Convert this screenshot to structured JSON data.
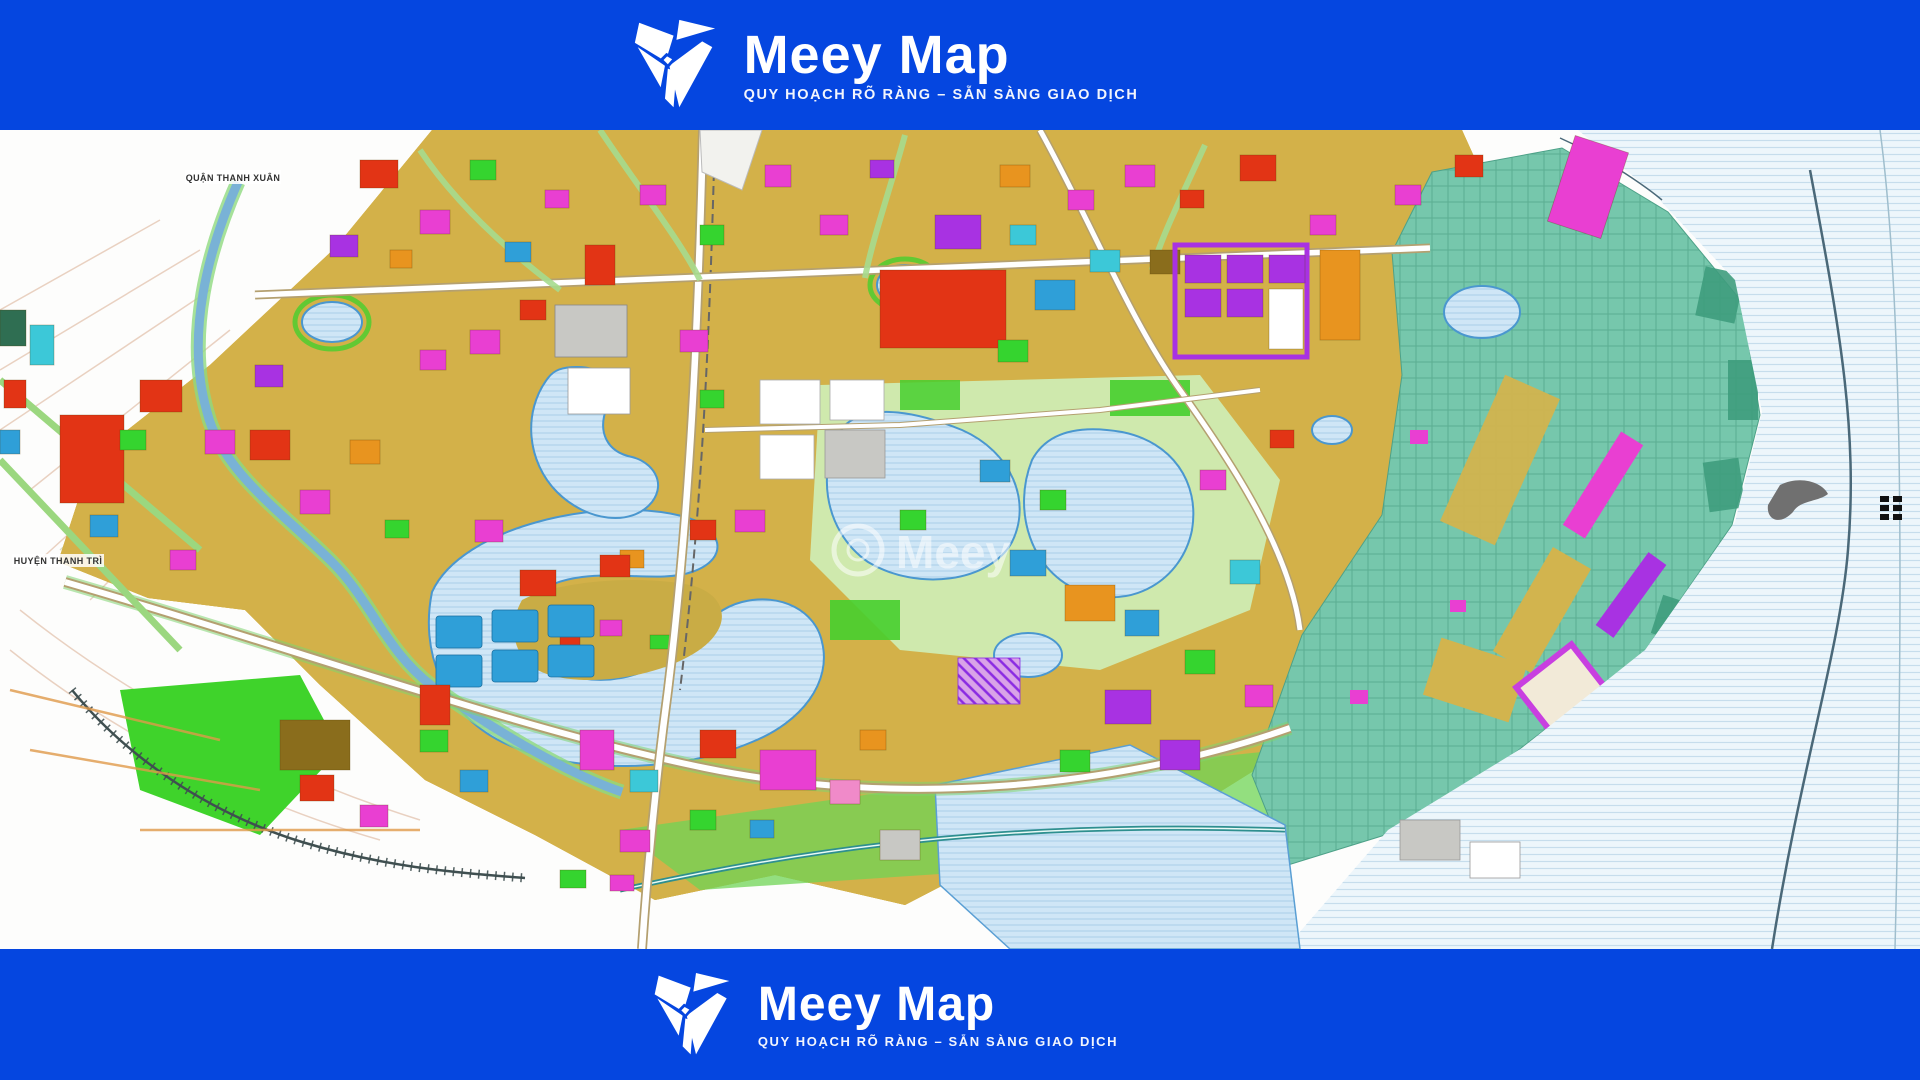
{
  "brand": {
    "name": "Meey Map",
    "tagline": "QUY HOẠCH RÕ RÀNG – SẴN SÀNG GIAO DỊCH"
  },
  "map": {
    "watermark": "Meey",
    "labels": [
      {
        "text": "QUẬN THANH XUÂN"
      },
      {
        "text": "HUYỆN THANH TRÌ"
      }
    ],
    "palette": {
      "brand_blue": "#0546E0",
      "urban_gold": "#d3b149",
      "urban_olive": "#b59b3d",
      "urban_tan": "#dd9c54",
      "park_green": "#3fd32b",
      "pale_green": "#cfe9ad",
      "water_blue": "#cfe6f6",
      "river_pale": "#edf6fb",
      "farm_teal": "#76c7ac",
      "parcel_red": "#e23415",
      "parcel_magenta": "#e93fd2",
      "parcel_purple": "#a832e2",
      "parcel_blue": "#2f9fd8",
      "parcel_orange": "#e8941f"
    }
  }
}
